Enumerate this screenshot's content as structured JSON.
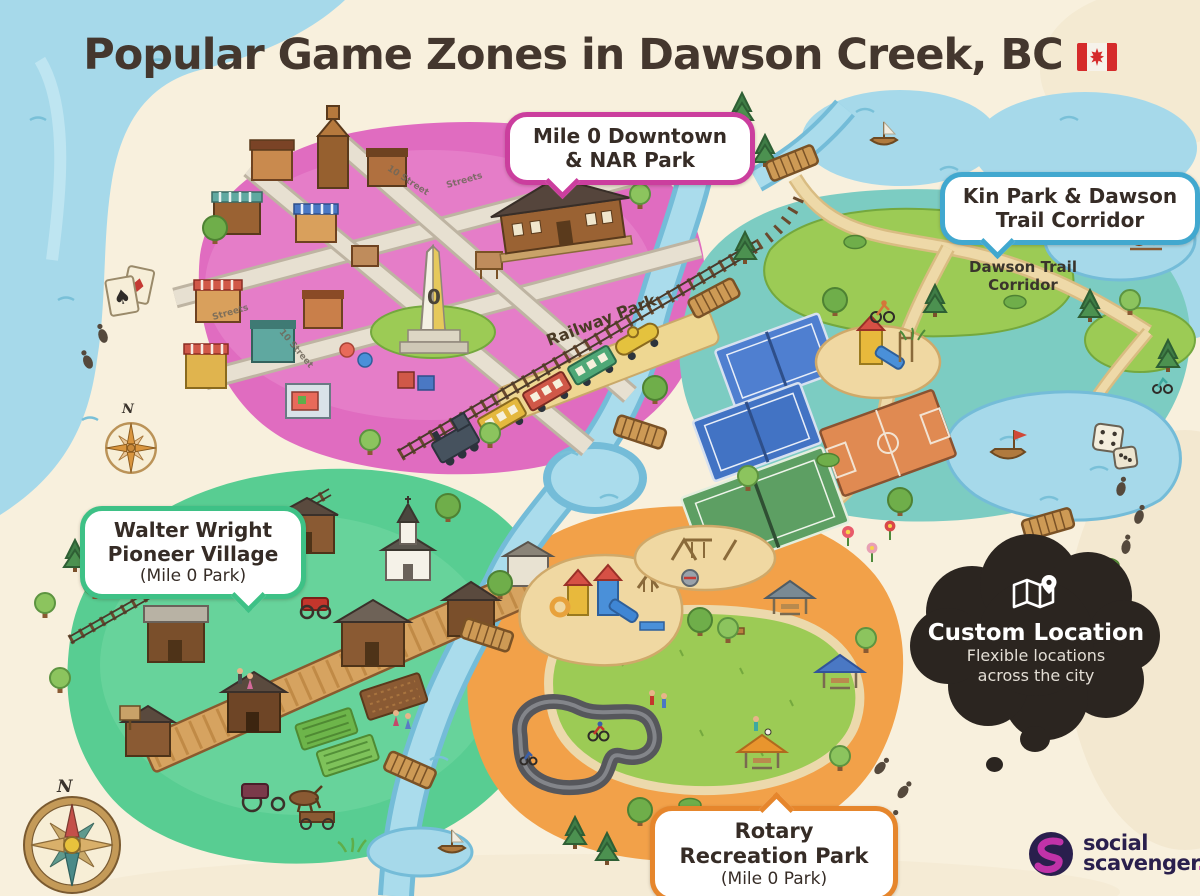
{
  "title": {
    "text": "Popular Game Zones in Dawson Creek, BC",
    "flag_alt": "canada-flag"
  },
  "callouts": {
    "downtown": {
      "line1": "Mile 0 Downtown",
      "line2": "& NAR Park"
    },
    "kin_park": {
      "line1": "Kin Park & Dawson",
      "line2": "Trail Corridor"
    },
    "pioneer_village": {
      "line1": "Walter Wright",
      "line2": "Pioneer Village",
      "line3": "(Mile 0 Park)"
    },
    "rotary_park": {
      "line1": "Rotary",
      "line2": "Recreation Park",
      "line3": "(Mile 0 Park)"
    }
  },
  "map_labels": {
    "railway_park": "Railway Park",
    "dawson_trail_line1": "Dawson Trail",
    "dawson_trail_line2": "Corridor",
    "street_1": "10 Street",
    "street_2": "Streets",
    "street_3": "Streets",
    "street_4": "10 Street",
    "obelisk_zero": "0",
    "compass_north": "N",
    "compass_north_small": "N"
  },
  "custom_location": {
    "title": "Custom Location",
    "line1": "Flexible locations",
    "line2": "across the city"
  },
  "logo": {
    "word1": "social",
    "word2": "scavenger",
    "period": "."
  },
  "icons": {
    "spade": "♠",
    "diamond": "♦"
  },
  "colors": {
    "background": "#f8f0dd",
    "title_text": "#44372e",
    "zone_downtown": "#e06cc0",
    "zone_kin_park": "#7cccc2",
    "zone_pioneer": "#58cd92",
    "zone_rotary": "#f2a149",
    "water": "#a6d9ea",
    "callout_downtown_border": "#cb3e9e",
    "callout_kin_border": "#41a8cf",
    "callout_pioneer_border": "#3ec186",
    "callout_rotary_border": "#e6862c",
    "cloud_bg": "#2b2520",
    "logo_navy": "#2a1f4d",
    "logo_magenta": "#c032a8"
  }
}
